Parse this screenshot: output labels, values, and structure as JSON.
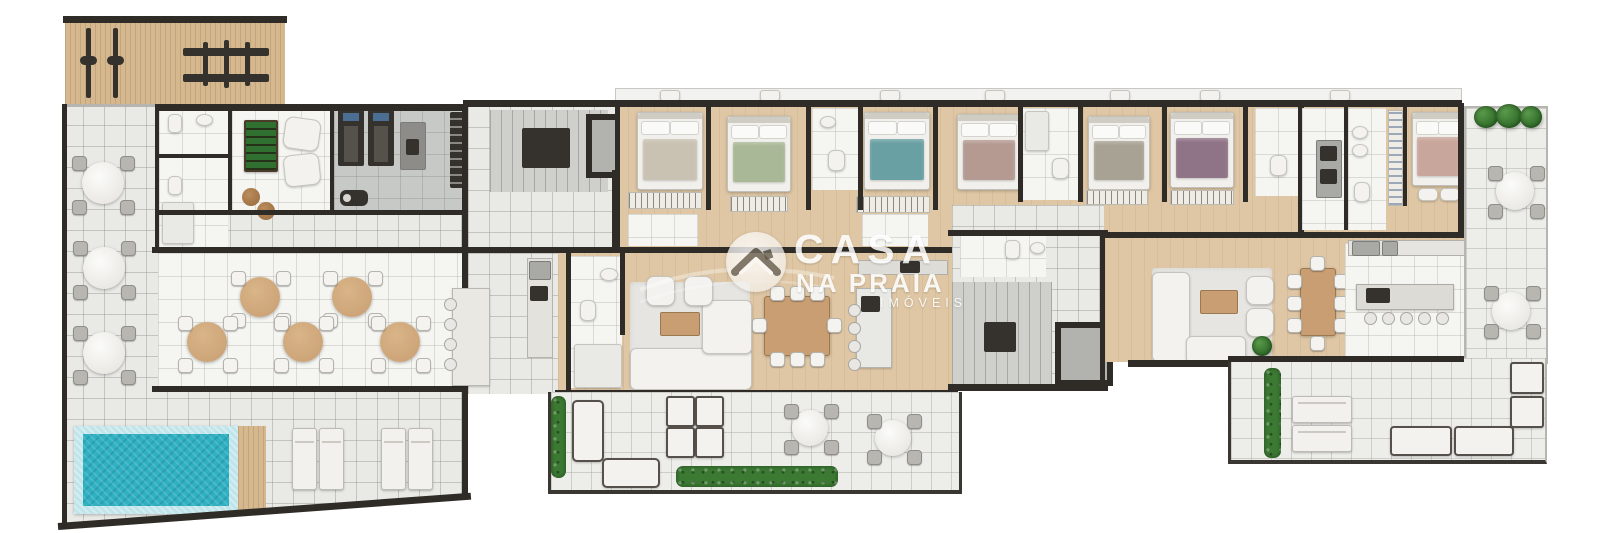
{
  "watermark": {
    "line1": "CASA",
    "line2": "NA PRAIA",
    "line3": "IMÓVEIS"
  },
  "colors": {
    "wall": "#2f2b26",
    "tile": "#e9e9e6",
    "white_room": "#f5f5f2",
    "wood": "#dfc7a5",
    "deck": "#d6b88f",
    "gym_floor": "#c7c9c6",
    "pool_water": "#2fb1c3",
    "pool_border": "#bfe4ea",
    "rug": "#e6e5e1",
    "sofa": "#f3f2ef",
    "table_wood": "#c89e72",
    "chair_gray": "#b8b6b1",
    "stool": "#e8e7e3",
    "plant": "#3c7a33",
    "foosball": "#2f7031",
    "equipment_dark": "#35322e",
    "treadmill_screen": "#4a6f93",
    "bed_1": "#c9c1b2",
    "bed_2": "#a9b896",
    "bed_3": "#69a0a3",
    "bed_4": "#b49a91",
    "bed_5": "#a8a294",
    "bed_6": "#8f7386",
    "bed_7": "#c9a69b",
    "watermark": "#ffffff"
  }
}
